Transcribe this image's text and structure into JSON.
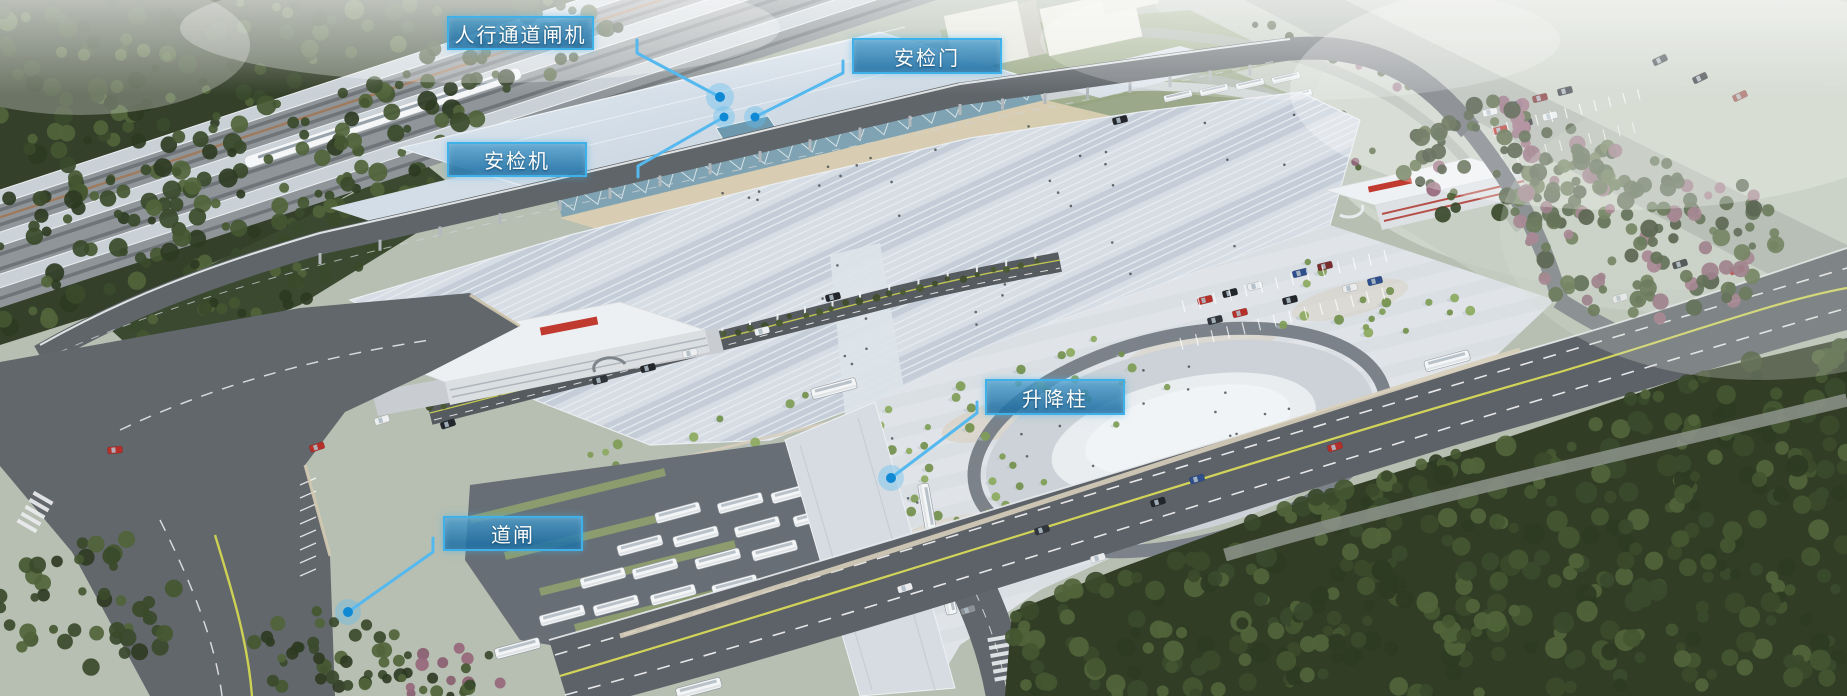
{
  "scene_type": "annotated-aerial-render-of-transport-hub",
  "style": {
    "callout_border_color": "#3fb1e8",
    "callout_fill_top": "rgba(74,157,205,0.80)",
    "callout_fill_bottom": "rgba(21,105,160,0.86)",
    "label_text_color": "#ffffff",
    "leader_line_color": "#55b9ef",
    "dot_color": "#0f89d4",
    "dot_halo_color": "rgba(95,190,240,0.38)"
  },
  "callouts": [
    {
      "id": "pedestrian-channel-gate",
      "label": "人行通道闸机",
      "box": {
        "x": 447,
        "y": 16,
        "w": 147,
        "h": 34
      },
      "line": [
        [
          637,
          40
        ],
        [
          637,
          53
        ],
        [
          720,
          97
        ]
      ],
      "dot": {
        "x": 720,
        "y": 97,
        "r": 5,
        "halo": 14
      }
    },
    {
      "id": "security-door",
      "label": "安检门",
      "box": {
        "x": 852,
        "y": 38,
        "w": 150,
        "h": 36
      },
      "line": [
        [
          843,
          61
        ],
        [
          843,
          73
        ],
        [
          755,
          117
        ]
      ],
      "dot": {
        "x": 755,
        "y": 117,
        "r": 4.5,
        "halo": 11
      }
    },
    {
      "id": "security-scanner",
      "label": "安检机",
      "box": {
        "x": 447,
        "y": 142,
        "w": 140,
        "h": 35
      },
      "line": [
        [
          638,
          177
        ],
        [
          638,
          166
        ],
        [
          724,
          117
        ]
      ],
      "dot": {
        "x": 724,
        "y": 117,
        "r": 4.5,
        "halo": 11
      }
    },
    {
      "id": "lifting-bollard",
      "label": "升降柱",
      "box": {
        "x": 985,
        "y": 379,
        "w": 140,
        "h": 36
      },
      "line": [
        [
          977,
          402
        ],
        [
          977,
          413
        ],
        [
          891,
          478
        ]
      ],
      "dot": {
        "x": 891,
        "y": 478,
        "r": 5,
        "halo": 13
      }
    },
    {
      "id": "road-barrier-gate",
      "label": "道闸",
      "box": {
        "x": 443,
        "y": 516,
        "w": 140,
        "h": 35
      },
      "line": [
        [
          433,
          538
        ],
        [
          433,
          552
        ],
        [
          348,
          612
        ]
      ],
      "dot": {
        "x": 348,
        "y": 612,
        "r": 5,
        "halo": 13
      }
    }
  ]
}
